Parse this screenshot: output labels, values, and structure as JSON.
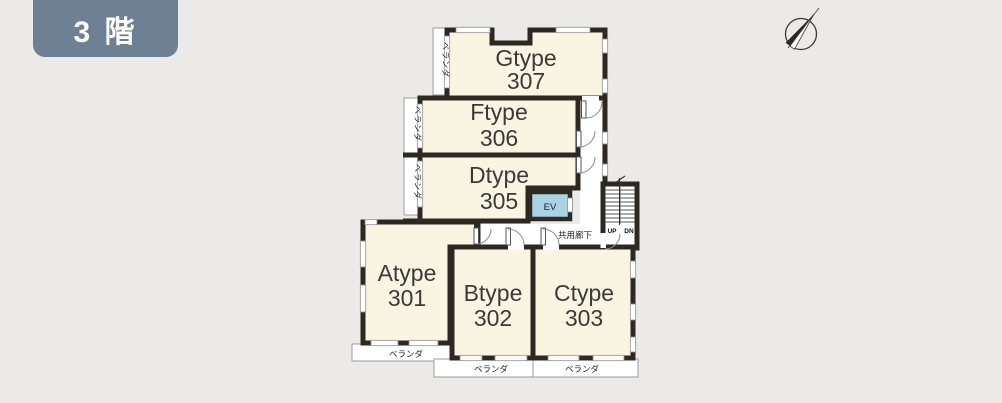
{
  "floor_badge": {
    "label": "3 階"
  },
  "rooms": [
    {
      "id": "gtype-307",
      "type_label": "Gtype",
      "number": "307"
    },
    {
      "id": "ftype-306",
      "type_label": "Ftype",
      "number": "306"
    },
    {
      "id": "dtype-305",
      "type_label": "Dtype",
      "number": "305"
    },
    {
      "id": "atype-301",
      "type_label": "Atype",
      "number": "301"
    },
    {
      "id": "btype-302",
      "type_label": "Btype",
      "number": "302"
    },
    {
      "id": "ctype-303",
      "type_label": "Ctype",
      "number": "303"
    }
  ],
  "labels": {
    "veranda": "ベランダ",
    "corridor": "共用廊下",
    "elevator": "EV",
    "stairs_up": "UP",
    "stairs_down": "DN"
  },
  "colors": {
    "background": "#eceae8",
    "wall": "#2e2823",
    "room_fill": "#faf5e2",
    "elevator_fill": "#a9d2e4",
    "badge": "#6e8093"
  }
}
